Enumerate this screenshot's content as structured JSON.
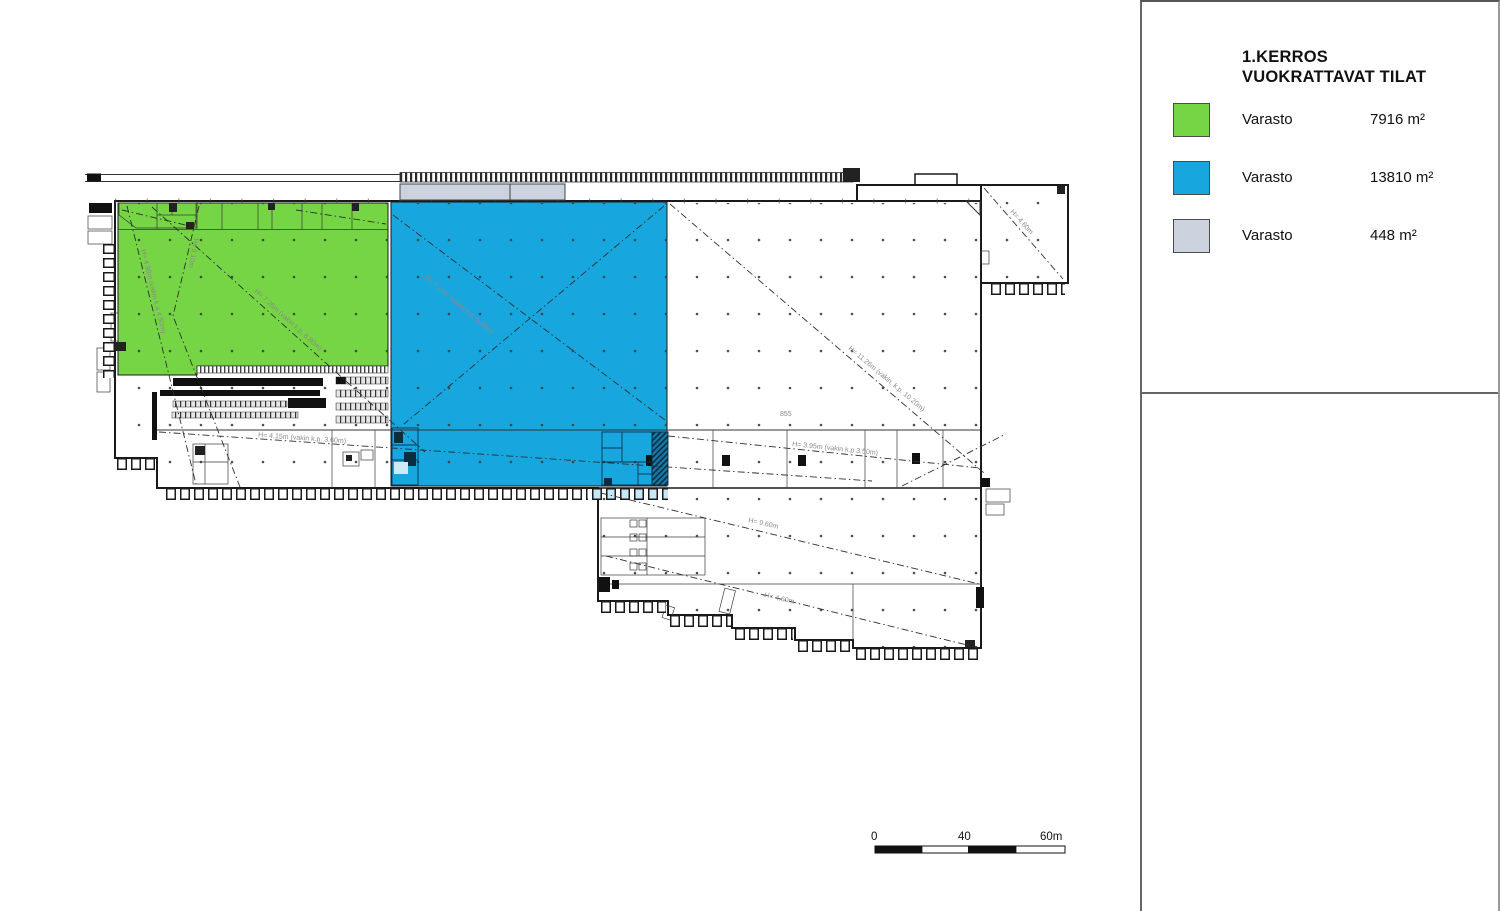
{
  "legend": {
    "title_line1": "1.KERROS",
    "title_line2": "VUOKRATTAVAT TILAT",
    "items": [
      {
        "label": "Varasto",
        "area": "7916 m²",
        "color": "#76d544"
      },
      {
        "label": "Varasto",
        "area": "13810 m²",
        "color": "#18a6de"
      },
      {
        "label": "Varasto",
        "area": "448 m²",
        "color": "#ccd3de"
      }
    ]
  },
  "scale_bar": {
    "labels": [
      "0",
      "40",
      "60m"
    ]
  },
  "plan": {
    "annotations": [
      {
        "text": "H= 4.90m (vakin k.a 4.50m)"
      },
      {
        "text": "Hs 8.10m"
      },
      {
        "text": "H= 7.26m (vakin k.p. 6.80m)"
      },
      {
        "text": "H= 7.26m (vakin k.p. 6.80m)"
      },
      {
        "text": "H= 11.26m (vakin. k.p. 10.20m)"
      },
      {
        "text": "H= 4.60m"
      },
      {
        "text": "H= 4.15m (vakin k.p. 3.60m)"
      },
      {
        "text": "H= 3.95m (vakin k.p 3.50m)"
      },
      {
        "text": "H= 9.60m"
      },
      {
        "text": "H= 4.60m"
      },
      {
        "text": "855"
      }
    ]
  },
  "colors": {
    "green": "#76d544",
    "blue": "#18a6de",
    "gray": "#ccd3de",
    "wall": "#1a1a1a"
  }
}
